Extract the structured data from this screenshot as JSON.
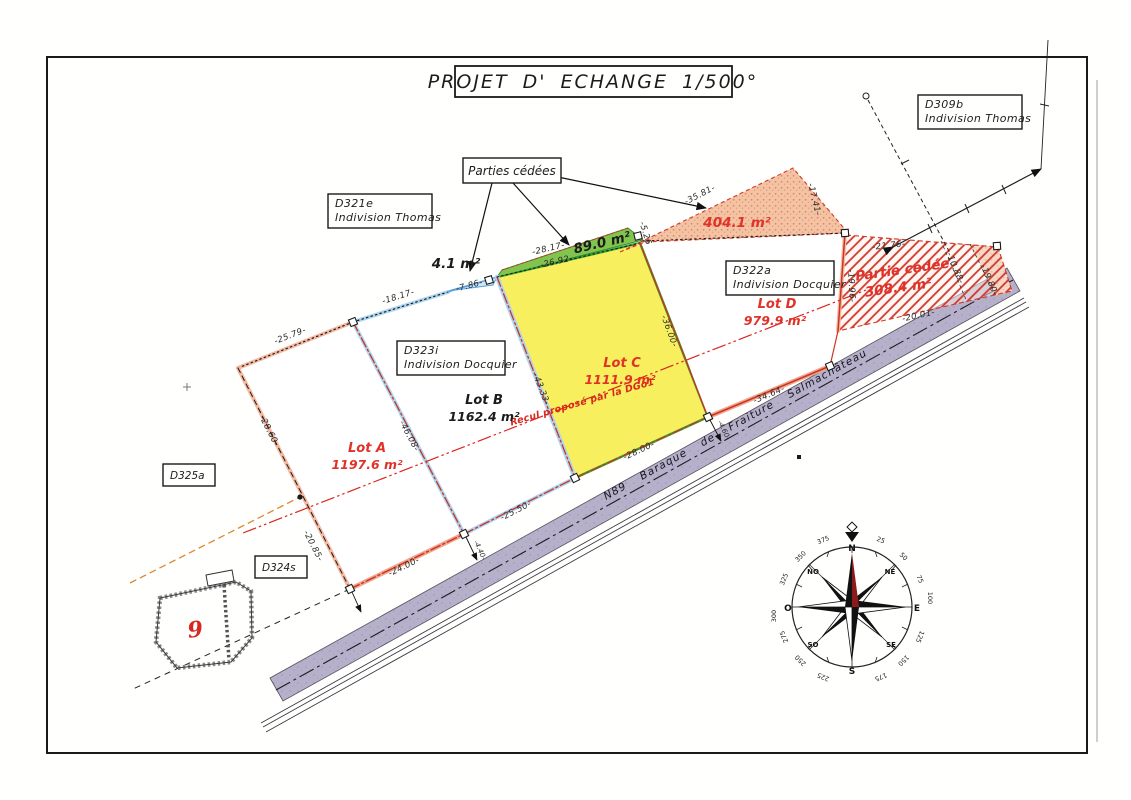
{
  "title": "PROJET D' ECHANGE  1/500°",
  "boxes": {
    "d309b": {
      "line1": "D309b",
      "line2": "Indivision Thomas"
    },
    "d321e": {
      "line1": "D321e",
      "line2": "Indivision Thomas"
    },
    "d322a": {
      "line1": "D322a",
      "line2": "Indivision Docquier"
    },
    "d323i": {
      "line1": "D323i",
      "line2": "Indivision Docquier"
    },
    "d325a": {
      "label": "D325a"
    },
    "d324s": {
      "label": "D324s"
    }
  },
  "callout": {
    "parties_cedees": "Parties cédées"
  },
  "lots": {
    "a": {
      "name": "Lot A",
      "area": "1197.6 m²"
    },
    "b": {
      "name": "Lot B",
      "area": "1162.4 m²"
    },
    "c": {
      "name": "Lot C",
      "area": "1111.9 m²"
    },
    "d": {
      "name": "Lot D",
      "area": "979.9 m²"
    }
  },
  "cessions": {
    "sliver_area": "4.1 m²",
    "strip_area": "89.0 m²",
    "north_area": "404.1 m²",
    "east_title": "Partie cédée",
    "east_area": "308.4 m²"
  },
  "recul_label": "Recul proposé par la DGo1",
  "road_label": "N89  Baraque de Fraiture  Salmachâteau",
  "building_number": "9",
  "dims": {
    "a_top": "-25.79-",
    "a_left_upper": "-28.60-",
    "a_left_lower": "-20.85-",
    "a_bottom": "-24.00-",
    "ab_edge": "-46.08-",
    "b_top": "-18.17-",
    "b_bottom": "-25.50-",
    "bc_edge": "-43.33-",
    "sliver": "-7.86-",
    "strip_top": "-28.17-",
    "strip_bottom": "-26.92-",
    "strip_end": "-5.26",
    "c_bottom": "-28.00-",
    "cd_edge": "-36.00-",
    "d_bottom": "-34.64-",
    "d_right": "-19.96-",
    "north_top": "-35.81-",
    "north_right": "-17.41-",
    "east_top": "-21.76-",
    "east_mid": "-10.88-",
    "east_right": "-19.80-",
    "east_bottom": "-20.01-",
    "tie_ab": "-4.40-",
    "tie_cd": "-4.60-"
  },
  "compass": {
    "n": "N",
    "ne": "NE",
    "e": "E",
    "se": "SE",
    "s": "S",
    "so": "SO",
    "o": "O",
    "no": "NO",
    "t25": "25",
    "t50": "50",
    "t75": "75",
    "t100": "100",
    "t125": "125",
    "t150": "150",
    "t175": "175",
    "t225": "225",
    "t250": "250",
    "t275": "275",
    "t300": "300",
    "t325": "325",
    "t350": "350",
    "t375": "375"
  },
  "colors": {
    "lot_c_fill": "#f7ef5e",
    "strip_fill": "#82c54e",
    "cession_stipple": "#f3c3a4",
    "hatch_red": "#d0392b",
    "road_fill": "#b6b0ca",
    "old_boundary_blue": "#aed5f0",
    "old_boundary_pink": "#f5b8a0",
    "new_boundary_red": "#cc3322",
    "label_red": "#e03228",
    "compass_red": "#8b1a1a"
  }
}
